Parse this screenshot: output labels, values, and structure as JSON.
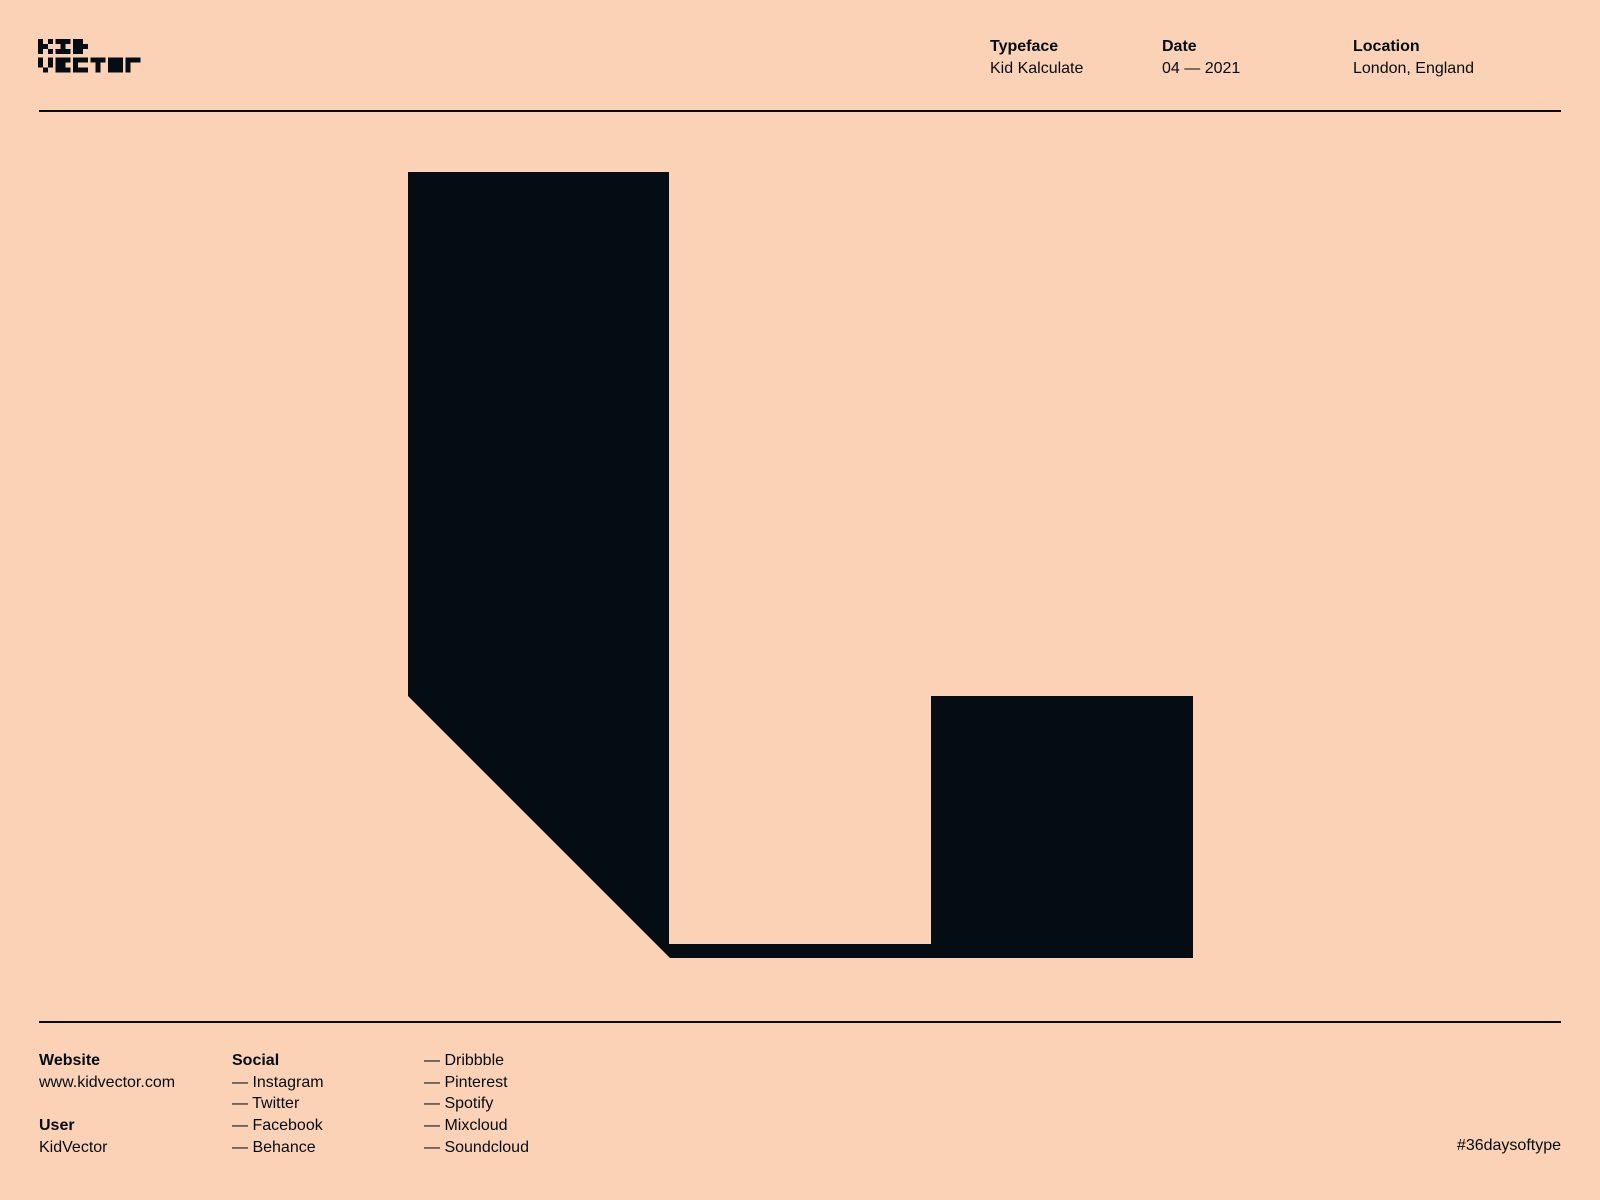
{
  "colors": {
    "background": "#FCD2B7",
    "ink": "#040D13"
  },
  "logo": {
    "line1": "KID",
    "line2": "VECTOR",
    "alt": "KidVector pixel logo"
  },
  "header": {
    "columns": [
      {
        "label": "Typeface",
        "value": "Kid Kalculate"
      },
      {
        "label": "Date",
        "value": "04 — 2021"
      },
      {
        "label": "Location",
        "value": "London, England"
      }
    ]
  },
  "glyph": {
    "name": "kid-kalculate-letter-artwork",
    "points": "408,172 669,172 669,944 931,944 931,696 1193,696 1193,958 670,958 408,696"
  },
  "footer": {
    "website_label": "Website",
    "website_value": "www.kidvector.com",
    "user_label": "User",
    "user_value": "KidVector",
    "social_label": "Social",
    "social_col1": [
      "— Instagram",
      "— Twitter",
      "— Facebook",
      "— Behance"
    ],
    "social_col2": [
      "— Dribbble",
      "— Pinterest",
      "— Spotify",
      "— Mixcloud",
      "— Soundcloud"
    ],
    "hashtag": "#36daysoftype"
  }
}
